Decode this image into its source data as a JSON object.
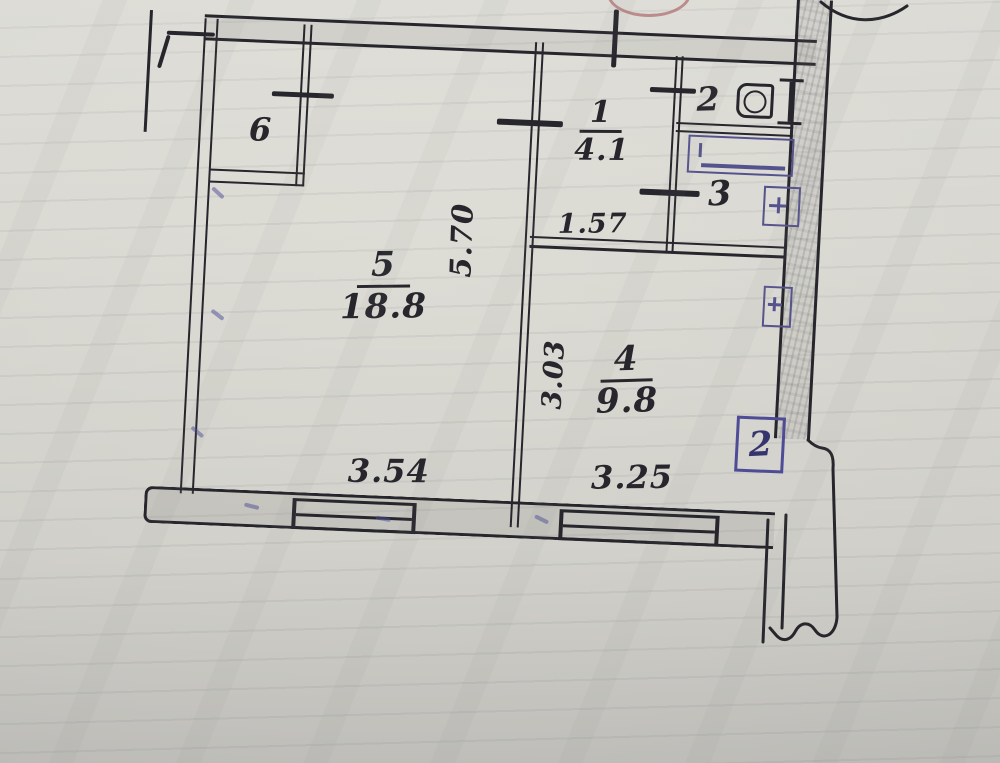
{
  "document": {
    "type": "hand-drawn apartment floor plan",
    "medium": "ink on lined paper, photographed",
    "colors": {
      "paper": "#d8d7d1",
      "ink": "#26262c",
      "blue_ink": "#55538e",
      "red_mark": "#aa5f64"
    }
  },
  "rooms": [
    {
      "number": "5",
      "area": "18.8"
    },
    {
      "number": "4",
      "area": "9.8"
    },
    {
      "number": "1",
      "area": "4.1"
    },
    {
      "number": "2"
    },
    {
      "number": "3"
    },
    {
      "number": "6"
    }
  ],
  "dimensions": [
    {
      "value": "3.54",
      "orientation": "horizontal",
      "location": "room 5 bottom"
    },
    {
      "value": "5.70",
      "orientation": "vertical",
      "location": "room 5 right, along middle wall"
    },
    {
      "value": "3.25",
      "orientation": "horizontal",
      "location": "room 4 bottom"
    },
    {
      "value": "3.03",
      "orientation": "vertical",
      "location": "room 4 left, along middle wall"
    },
    {
      "value": "1.57",
      "orientation": "horizontal",
      "location": "hallway room 1"
    }
  ],
  "badges": {
    "boxed_unit_label": "2"
  },
  "fixtures": [
    {
      "name": "toilet",
      "room": "2",
      "ink": "black"
    },
    {
      "name": "bathtub",
      "room": "3",
      "ink": "blue"
    },
    {
      "name": "washbasin",
      "room": "3",
      "ink": "blue"
    },
    {
      "name": "vent-box",
      "room": "4",
      "ink": "blue"
    }
  ]
}
